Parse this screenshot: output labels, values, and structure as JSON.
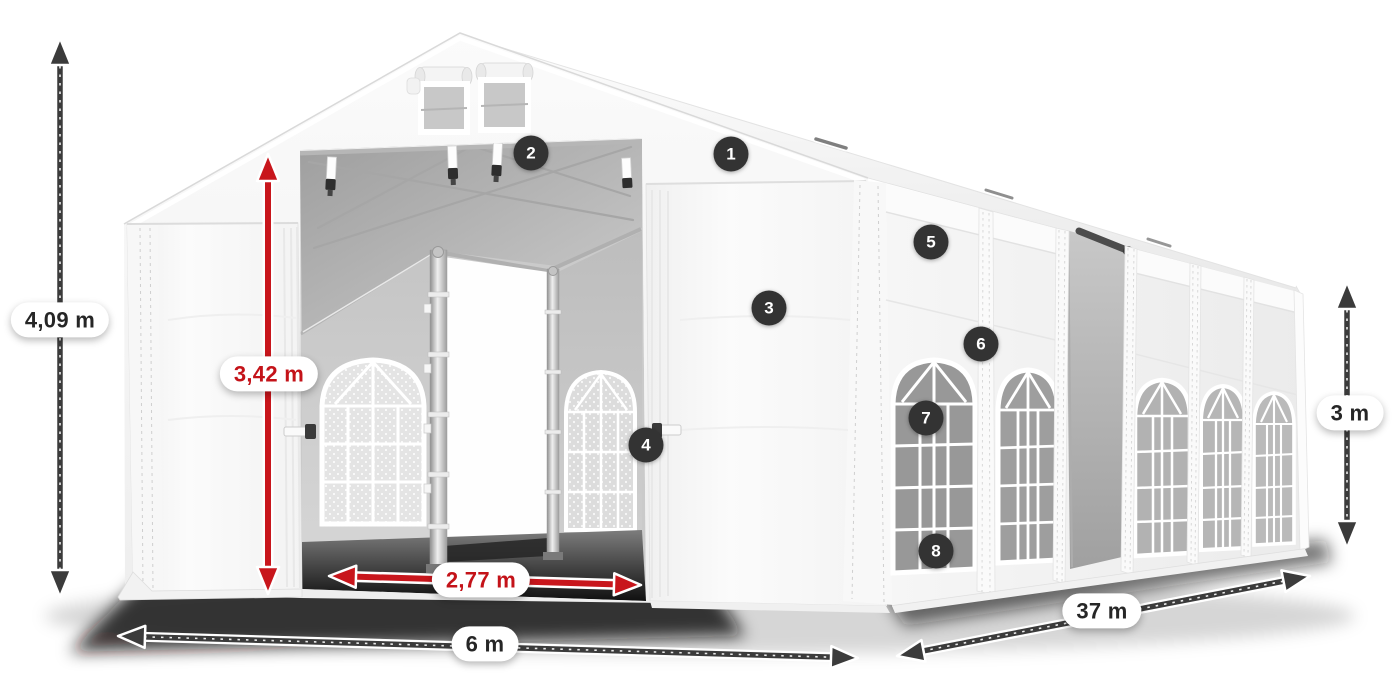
{
  "title": "Tent dimensions diagram",
  "colors": {
    "dimension_dark": "#3b3b3b",
    "dimension_red": "#c8161c",
    "label_text_dark": "#262626",
    "label_text_red": "#c41319",
    "label_background": "#ffffff",
    "hotspot_background": "#333333",
    "hotspot_text": "#ffffff"
  },
  "dimensions": {
    "total_height": {
      "label": "4,09 m",
      "style": "dark"
    },
    "entrance_height": {
      "label": "3,42 m",
      "style": "red"
    },
    "entrance_width": {
      "label": "2,77 m",
      "style": "red"
    },
    "front_width": {
      "label": "6 m",
      "style": "dark"
    },
    "side_length": {
      "label": "37 m",
      "style": "dark"
    },
    "side_height": {
      "label": "3 m",
      "style": "dark"
    }
  },
  "hotspots": [
    {
      "number": "1"
    },
    {
      "number": "2"
    },
    {
      "number": "3"
    },
    {
      "number": "4"
    },
    {
      "number": "5"
    },
    {
      "number": "6"
    },
    {
      "number": "7"
    },
    {
      "number": "8"
    }
  ]
}
